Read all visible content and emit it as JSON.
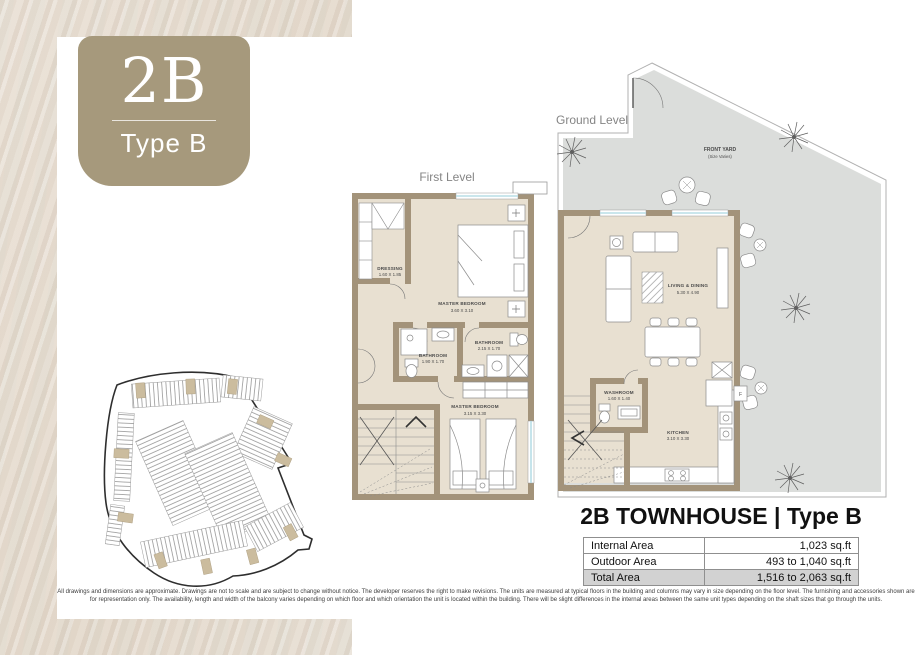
{
  "badge": {
    "code": "2B",
    "type": "Type B"
  },
  "plans": {
    "first_level": {
      "label": "First Level",
      "rooms": [
        {
          "name": "DRESSING",
          "dims": "1.60 X 1.85"
        },
        {
          "name": "MASTER BEDROOM",
          "dims": "3.60 X 3.10"
        },
        {
          "name": "BATHROOM",
          "dims": "2.15 X 1.70"
        },
        {
          "name": "BATHROOM",
          "dims": "1.90 X 1.70"
        },
        {
          "name": "MASTER BEDROOM",
          "dims": "3.15 X 3.30"
        }
      ]
    },
    "ground_level": {
      "label": "Ground Level",
      "appliance_fridge": "F",
      "rooms": [
        {
          "name": "FRONT YARD",
          "dims": "(Size Varies)"
        },
        {
          "name": "LIVING & DINING",
          "dims": "5.30 X 4.90"
        },
        {
          "name": "WASHROOM",
          "dims": "1.60 X 1.40"
        },
        {
          "name": "KITCHEN",
          "dims": "3.10 X 3.30"
        }
      ]
    }
  },
  "summary": {
    "title": "2B TOWNHOUSE | Type B",
    "rows": [
      {
        "label": "Internal Area",
        "value": "1,023 sq.ft"
      },
      {
        "label": "Outdoor Area",
        "value": "493 to 1,040 sq.ft"
      },
      {
        "label": "Total Area",
        "value": "1,516 to 2,063 sq.ft"
      }
    ]
  },
  "disclaimer": {
    "line1": "All drawings and dimensions are approximate. Drawings are not to scale and are subject to change without notice. The developer reserves the right to make revisions. The units are measured at typical floors in the building and columns may vary in size depending on the floor level. The furnishing and accessories shown are",
    "line2": "for representation only. The availability, length and width of the balcony varies depending on which floor and which orientation the unit is located within the building. There will be slight differences in the internal areas between the same unit types depending on the shaft sizes that go through the units."
  },
  "colors": {
    "accent_taupe": "#a6997c",
    "wall_taupe": "#a3937a",
    "floor_beige": "#e8e0d1",
    "yard_gray": "#dbdddb",
    "window_blue": "#b8dde6",
    "total_row_gray": "#d2d2d2"
  }
}
